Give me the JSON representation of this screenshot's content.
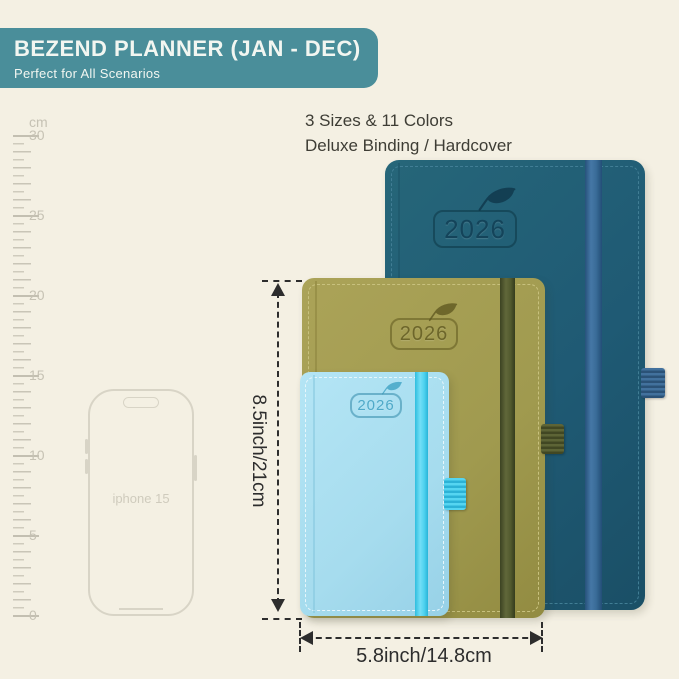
{
  "banner": {
    "title": "BEZEND PLANNER (JAN - DEC)",
    "subtitle": "Perfect for All Scenarios"
  },
  "features": {
    "line1": "3 Sizes & 11 Colors",
    "line2": "Deluxe Binding / Hardcover"
  },
  "ruler": {
    "unit": "cm",
    "labels": [
      "30",
      "25",
      "20",
      "15",
      "10",
      "5",
      "0"
    ]
  },
  "phone": {
    "label": "iphone 15"
  },
  "planners": {
    "large": {
      "year": "2026",
      "cover_color": "#1f5a74",
      "band_color": "#3a6c98"
    },
    "medium": {
      "year": "2026",
      "cover_color": "#a09a4f",
      "band_color": "#525a2e"
    },
    "small": {
      "year": "2026",
      "cover_color": "#a6dcee",
      "band_color": "#4fd2ef"
    }
  },
  "dimensions": {
    "height_label": "8.5inch/21cm",
    "width_label": "5.8inch/14.8cm"
  },
  "colors": {
    "background": "#f4f0e3",
    "banner_bg": "#4a8e9a",
    "annotation": "#2d2d2d",
    "ruler": "#c6c2b4"
  }
}
